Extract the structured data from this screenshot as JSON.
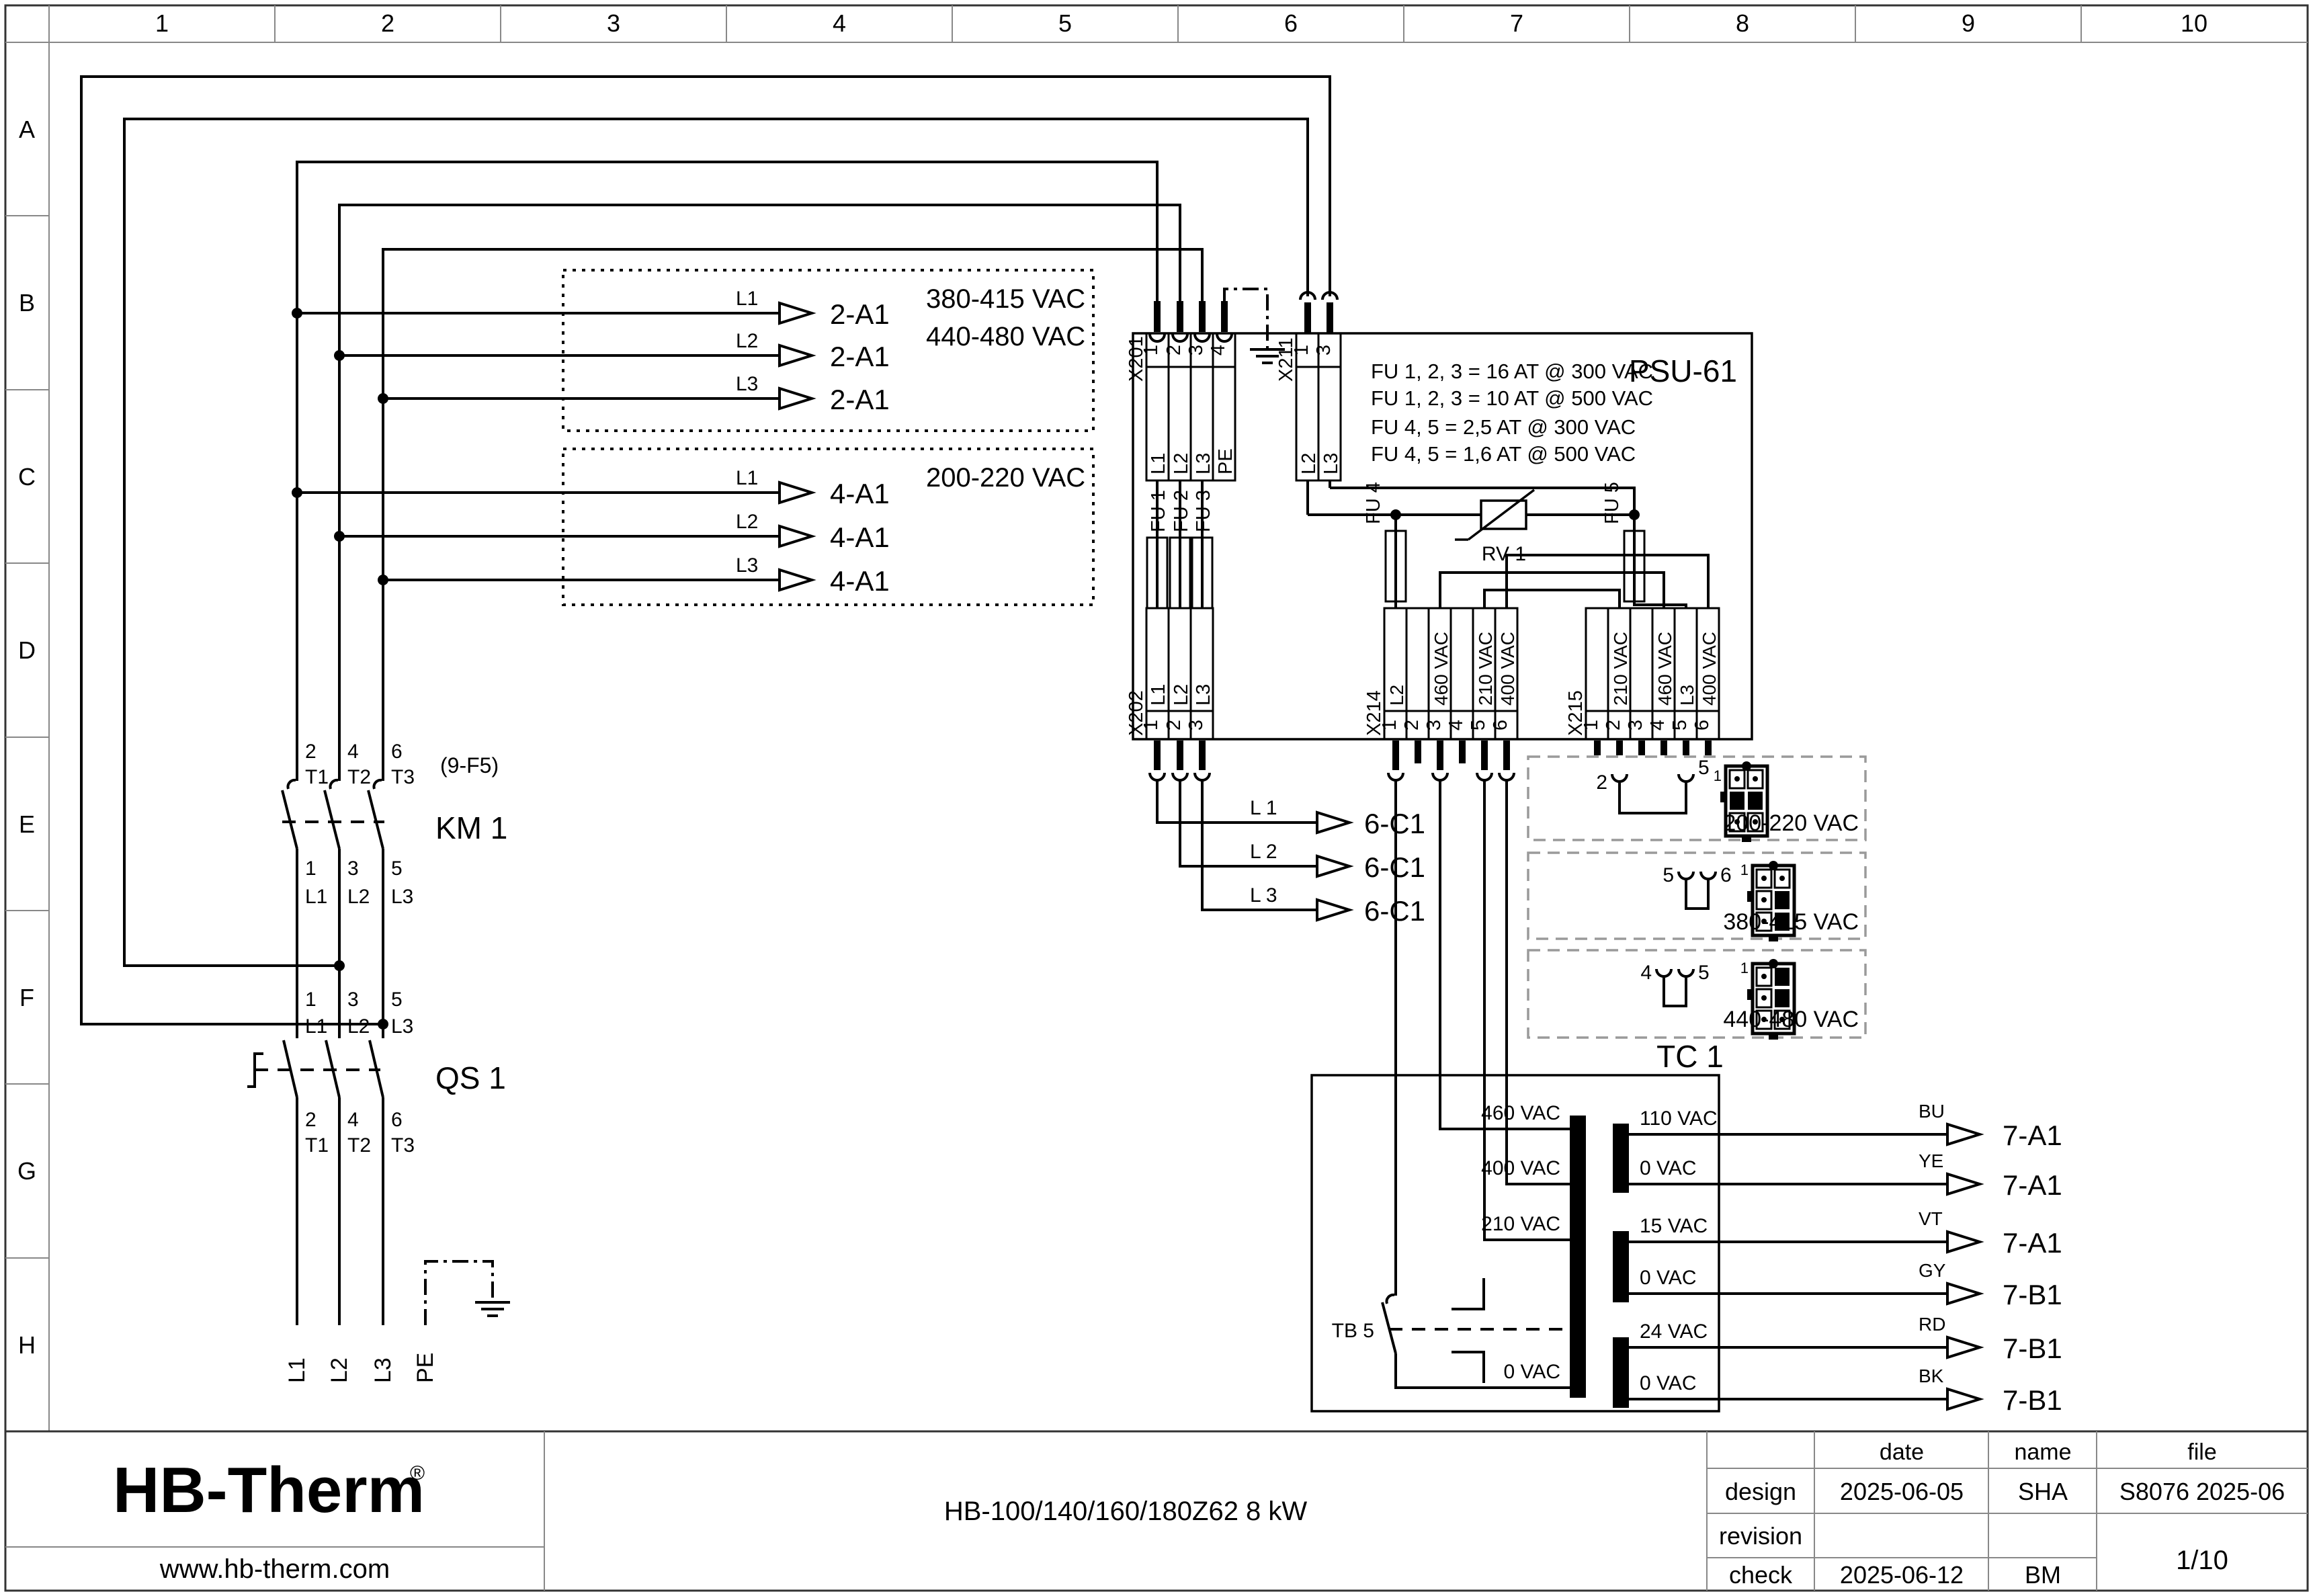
{
  "page": {
    "cols": [
      "1",
      "2",
      "3",
      "4",
      "5",
      "6",
      "7",
      "8",
      "9",
      "10"
    ],
    "rows": [
      "A",
      "B",
      "C",
      "D",
      "E",
      "F",
      "G",
      "H"
    ]
  },
  "phases": [
    "L1",
    "L2",
    "L3"
  ],
  "phases_spaced": [
    "L 1",
    "L 2",
    "L 3"
  ],
  "pe": "PE",
  "feed_hv": {
    "ref": "2-A1",
    "voltages": [
      "380-415 VAC",
      "440-480 VAC"
    ]
  },
  "feed_lv": {
    "ref": "4-A1",
    "voltage": "200-220 VAC"
  },
  "psu": {
    "title": "PSU-61",
    "notes": [
      "FU 1, 2, 3 = 16 AT @ 300 VAC",
      "FU 1, 2, 3 = 10 AT @ 500 VAC",
      "FU 4, 5 = 2,5 AT @ 300 VAC",
      "FU 4, 5 = 1,6 AT @ 500 VAC"
    ],
    "x201": {
      "label": "X201",
      "pins": [
        "1",
        "2",
        "3",
        "4"
      ],
      "names": [
        "L1",
        "L2",
        "L3",
        "PE"
      ]
    },
    "x211": {
      "label": "X211",
      "pins": [
        "1",
        "3"
      ],
      "names": [
        "L2",
        "L3"
      ]
    },
    "x202": {
      "label": "X202",
      "pins": [
        "1",
        "2",
        "3"
      ],
      "names": [
        "L1",
        "L2",
        "L3"
      ]
    },
    "x214": {
      "label": "X214",
      "pins": [
        "1",
        "2",
        "3",
        "4",
        "5",
        "6"
      ],
      "names": [
        "L2",
        "",
        "460 VAC",
        "",
        "210 VAC",
        "400 VAC"
      ]
    },
    "x215": {
      "label": "X215",
      "pins": [
        "1",
        "2",
        "3",
        "4",
        "5",
        "6"
      ],
      "names": [
        "",
        "210 VAC",
        "",
        "460 VAC",
        "L3",
        "400 VAC"
      ]
    },
    "fuses": [
      "FU 1",
      "FU 2",
      "FU 3",
      "FU 4",
      "FU 5"
    ],
    "varistor": "RV 1"
  },
  "km1": {
    "name": "KM 1",
    "ref": "(9-F5)",
    "top_no": [
      "2",
      "4",
      "6"
    ],
    "top_t": [
      "T1",
      "T2",
      "T3"
    ],
    "bot_no": [
      "1",
      "3",
      "5"
    ]
  },
  "qs1": {
    "name": "QS 1",
    "top_no": [
      "1",
      "3",
      "5"
    ],
    "bot_no": [
      "2",
      "4",
      "6"
    ],
    "bot_t": [
      "T1",
      "T2",
      "T3"
    ]
  },
  "c1_ref": "6-C1",
  "tc1": {
    "name": "TC 1",
    "breaker": "TB 5",
    "primary": [
      "460 VAC",
      "400 VAC",
      "210 VAC",
      "0 VAC"
    ],
    "secondary": [
      "110 VAC",
      "0 VAC",
      "15 VAC",
      "0 VAC",
      "24 VAC",
      "0 VAC"
    ],
    "wire_colors": [
      "BU",
      "YE",
      "VT",
      "GY",
      "RD",
      "BK"
    ],
    "out_refs": [
      "7-A1",
      "7-A1",
      "7-A1",
      "7-B1",
      "7-B1",
      "7-B1"
    ]
  },
  "coding": {
    "pin1": "1",
    "boxes": [
      {
        "a": "2",
        "b": "5",
        "v": "200-220 VAC"
      },
      {
        "a": "5",
        "b": "6",
        "v": "380-415 VAC"
      },
      {
        "a": "4",
        "b": "5",
        "v": "440-480 VAC"
      }
    ]
  },
  "titleblock": {
    "logo": "HB-Therm",
    "reg": "®",
    "url": "www.hb-therm.com",
    "doc": "HB-100/140/160/180Z62 8 kW",
    "h_date": "date",
    "h_name": "name",
    "h_file": "file",
    "design": "design",
    "revision": "revision",
    "check": "check",
    "design_date": "2025-06-05",
    "design_name": "SHA",
    "file_no": "S8076 2025-06",
    "check_date": "2025-06-12",
    "check_name": "BM",
    "page_no": "1/10",
    "brand_color": "#16254d"
  }
}
